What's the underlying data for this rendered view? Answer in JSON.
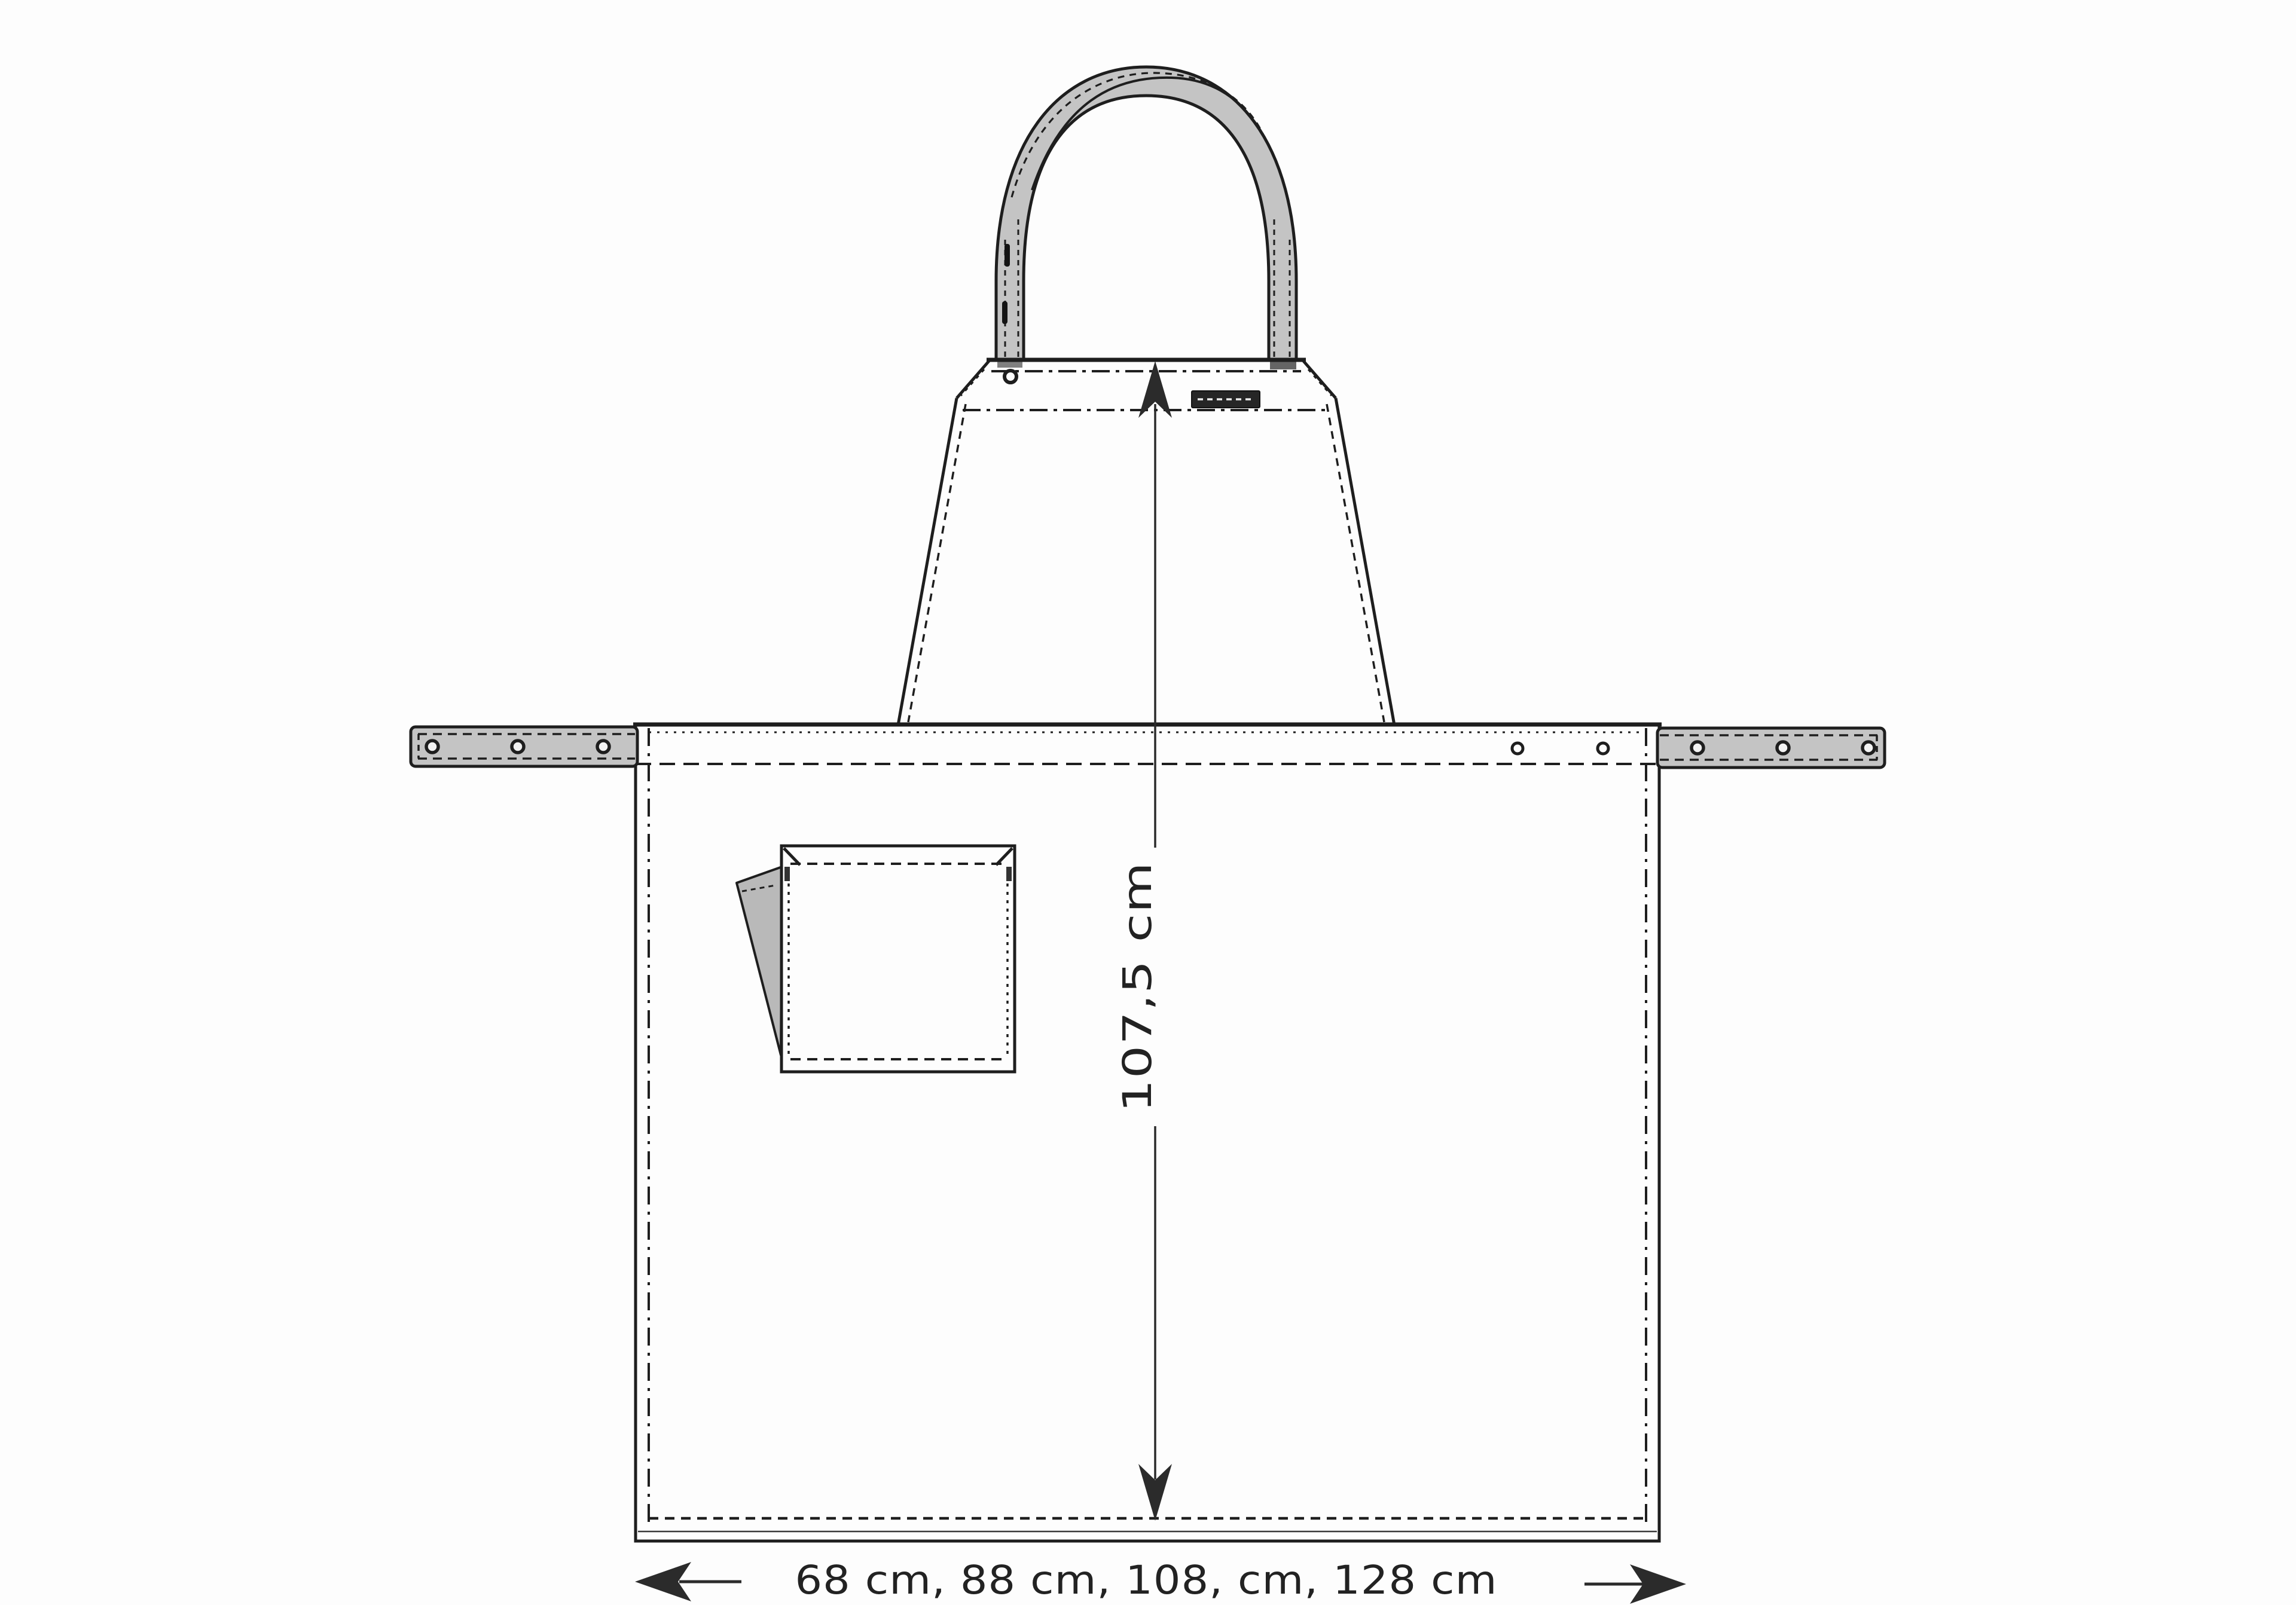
{
  "figure": {
    "name": "apron-technical-flat-sketch",
    "view": "front"
  },
  "colors": {
    "bg": "#fdfdfd",
    "ink": "#1e1e1e",
    "dim": "#2b2b2b",
    "fabric": "#c4c4c4",
    "flap": "#b9b9b9",
    "label-bg": "#262626",
    "label-stitch": "#ececec"
  },
  "dimensions": {
    "height_label": "107,5 cm",
    "width_label": "68 cm, 88 cm, 108, cm, 128 cm"
  },
  "details": {
    "tie_eyelets_per_side": 3,
    "body_eyelets_right": 2,
    "strap_buttonholes": 2
  }
}
